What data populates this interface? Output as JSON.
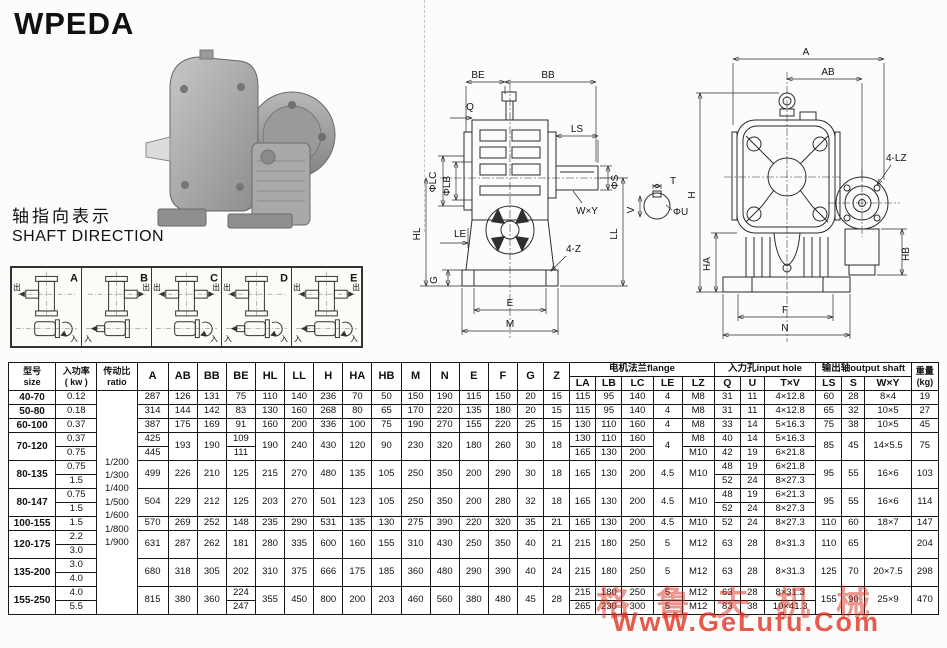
{
  "title": "WPEDA",
  "shaft_direction": {
    "cn": "轴指向表示",
    "en": "SHAFT DIRECTION"
  },
  "shaft_diagrams": {
    "out_label": "出",
    "in_label": "入",
    "items": [
      {
        "label": "A",
        "out_left": true,
        "out_right": false,
        "in_left": false,
        "in_right": true
      },
      {
        "label": "B",
        "out_left": false,
        "out_right": true,
        "in_left": true,
        "in_right": false
      },
      {
        "label": "C",
        "out_left": true,
        "out_right": true,
        "in_left": false,
        "in_right": true
      },
      {
        "label": "D",
        "out_left": true,
        "out_right": false,
        "in_left": true,
        "in_right": true
      },
      {
        "label": "E",
        "out_left": true,
        "out_right": true,
        "in_left": true,
        "in_right": true
      }
    ]
  },
  "drawing_side": {
    "BE": "BE",
    "BB": "BB",
    "Q": "Q",
    "LS": "LS",
    "PHI_S": "ΦS",
    "WxY": "W×Y",
    "PHI_LC": "ΦLC",
    "PHI_LB": "ΦLB",
    "LE": "LE",
    "HL": "HL",
    "LL": "LL",
    "Z4": "4-Z",
    "G": "G",
    "E": "E",
    "M": "M",
    "T": "T",
    "V": "V",
    "PHI_U": "ΦU"
  },
  "drawing_front": {
    "A": "A",
    "AB": "AB",
    "H": "H",
    "HA": "HA",
    "HB": "HB",
    "LZ4": "4-LZ",
    "F": "F",
    "N": "N"
  },
  "table": {
    "header": {
      "size_cn": "型号",
      "size_en": "size",
      "power_cn": "入功率",
      "power_en": "( kw )",
      "ratio_cn": "传动比",
      "ratio_en": "ratio",
      "dims": [
        "A",
        "AB",
        "BB",
        "BE",
        "HL",
        "LL",
        "H",
        "HA",
        "HB",
        "M",
        "N",
        "E",
        "F",
        "G",
        "Z"
      ],
      "flange_group": "电机法兰flange",
      "flange_cols": [
        "LA",
        "LB",
        "LC",
        "LE",
        "LZ"
      ],
      "input_group": "入力孔input hole",
      "input_cols": [
        "Q",
        "U",
        "T×V"
      ],
      "output_group": "输出轴output shaft",
      "output_cols": [
        "LS",
        "S",
        "W×Y"
      ],
      "weight_cn": "重量",
      "weight_en": "(kg)"
    },
    "ratios": [
      "1/200",
      "1/300",
      "1/400",
      "1/500",
      "1/600",
      "1/800",
      "1/900"
    ],
    "rows": [
      [
        {
          "v": "40-70",
          "cls": "model"
        },
        "0.12",
        {
          "ratio": true,
          "r": 16
        },
        "287",
        "126",
        "131",
        "75",
        "110",
        "140",
        "236",
        "70",
        "50",
        "150",
        "190",
        "115",
        "150",
        "20",
        "15",
        "115",
        "95",
        "140",
        "4",
        "M8",
        "31",
        "11",
        "4×12.8",
        "60",
        "28",
        "8×4",
        "19"
      ],
      [
        {
          "v": "50-80",
          "cls": "model"
        },
        "0.18",
        "314",
        "144",
        "142",
        "83",
        "130",
        "160",
        "268",
        "80",
        "65",
        "170",
        "220",
        "135",
        "180",
        "20",
        "15",
        "115",
        "95",
        "140",
        "4",
        "M8",
        "31",
        "11",
        "4×12.8",
        "65",
        "32",
        "10×5",
        "27"
      ],
      [
        {
          "v": "60-100",
          "cls": "model"
        },
        "0.37",
        "387",
        "175",
        "169",
        "91",
        "160",
        "200",
        "336",
        "100",
        "75",
        "190",
        "270",
        "155",
        "220",
        "25",
        "15",
        "130",
        "110",
        "160",
        "4",
        "M8",
        "33",
        "14",
        "5×16.3",
        "75",
        "38",
        "10×5",
        "45"
      ],
      [
        {
          "v": "70-120",
          "cls": "model",
          "r": 2
        },
        "0.37",
        "425",
        {
          "v": "193",
          "r": 2
        },
        {
          "v": "190",
          "r": 2
        },
        "109",
        {
          "v": "190",
          "r": 2
        },
        {
          "v": "240",
          "r": 2
        },
        {
          "v": "430",
          "r": 2
        },
        {
          "v": "120",
          "r": 2
        },
        {
          "v": "90",
          "r": 2
        },
        {
          "v": "230",
          "r": 2
        },
        {
          "v": "320",
          "r": 2
        },
        {
          "v": "180",
          "r": 2
        },
        {
          "v": "260",
          "r": 2
        },
        {
          "v": "30",
          "r": 2
        },
        {
          "v": "18",
          "r": 2
        },
        "130",
        "110",
        "160",
        {
          "v": "4",
          "r": 2
        },
        "M8",
        "40",
        "14",
        "5×16.3",
        {
          "v": "85",
          "r": 2
        },
        {
          "v": "45",
          "r": 2
        },
        {
          "v": "14×5.5",
          "r": 2
        },
        {
          "v": "75",
          "r": 2
        }
      ],
      [
        "0.75",
        "445",
        "111",
        "165",
        "130",
        "200",
        "M10",
        "42",
        "19",
        "6×21.8"
      ],
      [
        {
          "v": "80-135",
          "cls": "model",
          "r": 2
        },
        "0.75",
        {
          "v": "499",
          "r": 2
        },
        {
          "v": "226",
          "r": 2
        },
        {
          "v": "210",
          "r": 2
        },
        {
          "v": "125",
          "r": 2
        },
        {
          "v": "215",
          "r": 2
        },
        {
          "v": "270",
          "r": 2
        },
        {
          "v": "480",
          "r": 2
        },
        {
          "v": "135",
          "r": 2
        },
        {
          "v": "105",
          "r": 2
        },
        {
          "v": "250",
          "r": 2
        },
        {
          "v": "350",
          "r": 2
        },
        {
          "v": "200",
          "r": 2
        },
        {
          "v": "290",
          "r": 2
        },
        {
          "v": "30",
          "r": 2
        },
        {
          "v": "18",
          "r": 2
        },
        {
          "v": "165",
          "r": 2
        },
        {
          "v": "130",
          "r": 2
        },
        {
          "v": "200",
          "r": 2
        },
        {
          "v": "4.5",
          "r": 2
        },
        {
          "v": "M10",
          "r": 2
        },
        "48",
        "19",
        "6×21.8",
        {
          "v": "95",
          "r": 2
        },
        {
          "v": "55",
          "r": 2
        },
        {
          "v": "16×6",
          "r": 2
        },
        {
          "v": "103",
          "r": 2
        }
      ],
      [
        "1.5",
        "52",
        "24",
        "8×27.3"
      ],
      [
        {
          "v": "80-147",
          "cls": "model",
          "r": 2
        },
        "0.75",
        {
          "v": "504",
          "r": 2
        },
        {
          "v": "229",
          "r": 2
        },
        {
          "v": "212",
          "r": 2
        },
        {
          "v": "125",
          "r": 2
        },
        {
          "v": "203",
          "r": 2
        },
        {
          "v": "270",
          "r": 2
        },
        {
          "v": "501",
          "r": 2
        },
        {
          "v": "123",
          "r": 2
        },
        {
          "v": "105",
          "r": 2
        },
        {
          "v": "250",
          "r": 2
        },
        {
          "v": "350",
          "r": 2
        },
        {
          "v": "200",
          "r": 2
        },
        {
          "v": "280",
          "r": 2
        },
        {
          "v": "32",
          "r": 2
        },
        {
          "v": "18",
          "r": 2
        },
        {
          "v": "165",
          "r": 2
        },
        {
          "v": "130",
          "r": 2
        },
        {
          "v": "200",
          "r": 2
        },
        {
          "v": "4.5",
          "r": 2
        },
        {
          "v": "M10",
          "r": 2
        },
        "48",
        "19",
        "6×21.3",
        {
          "v": "95",
          "r": 2
        },
        {
          "v": "55",
          "r": 2
        },
        {
          "v": "16×6",
          "r": 2
        },
        {
          "v": "114",
          "r": 2
        }
      ],
      [
        "1.5",
        "52",
        "24",
        "8×27.3"
      ],
      [
        {
          "v": "100-155",
          "cls": "model"
        },
        "1.5",
        "570",
        "269",
        "252",
        "148",
        "235",
        "290",
        "531",
        "135",
        "130",
        "275",
        "390",
        "220",
        "320",
        "35",
        "21",
        "165",
        "130",
        "200",
        "4.5",
        "M10",
        "52",
        "24",
        "8×27.3",
        "110",
        "60",
        "18×7",
        "147"
      ],
      [
        {
          "v": "120-175",
          "cls": "model",
          "r": 2
        },
        "2.2",
        {
          "v": "631",
          "r": 2
        },
        {
          "v": "287",
          "r": 2
        },
        {
          "v": "262",
          "r": 2
        },
        {
          "v": "181",
          "r": 2
        },
        {
          "v": "280",
          "r": 2
        },
        {
          "v": "335",
          "r": 2
        },
        {
          "v": "600",
          "r": 2
        },
        {
          "v": "160",
          "r": 2
        },
        {
          "v": "155",
          "r": 2
        },
        {
          "v": "310",
          "r": 2
        },
        {
          "v": "430",
          "r": 2
        },
        {
          "v": "250",
          "r": 2
        },
        {
          "v": "350",
          "r": 2
        },
        {
          "v": "40",
          "r": 2
        },
        {
          "v": "21",
          "r": 2
        },
        {
          "v": "215",
          "r": 2
        },
        {
          "v": "180",
          "r": 2
        },
        {
          "v": "250",
          "r": 2
        },
        {
          "v": "5",
          "r": 2
        },
        {
          "v": "M12",
          "r": 2
        },
        {
          "v": "63",
          "r": 2
        },
        {
          "v": "28",
          "r": 2
        },
        {
          "v": "8×31.3",
          "r": 2
        },
        {
          "v": "110",
          "r": 2
        },
        {
          "v": "65",
          "r": 2
        },
        {
          "v": "",
          "r": 2
        },
        {
          "v": "204",
          "r": 2
        }
      ],
      [
        "3.0"
      ],
      [
        {
          "v": "135-200",
          "cls": "model",
          "r": 2
        },
        "3.0",
        {
          "v": "680",
          "r": 2
        },
        {
          "v": "318",
          "r": 2
        },
        {
          "v": "305",
          "r": 2
        },
        {
          "v": "202",
          "r": 2
        },
        {
          "v": "310",
          "r": 2
        },
        {
          "v": "375",
          "r": 2
        },
        {
          "v": "666",
          "r": 2
        },
        {
          "v": "175",
          "r": 2
        },
        {
          "v": "185",
          "r": 2
        },
        {
          "v": "360",
          "r": 2
        },
        {
          "v": "480",
          "r": 2
        },
        {
          "v": "290",
          "r": 2
        },
        {
          "v": "390",
          "r": 2
        },
        {
          "v": "40",
          "r": 2
        },
        {
          "v": "24",
          "r": 2
        },
        {
          "v": "215",
          "r": 2
        },
        {
          "v": "180",
          "r": 2
        },
        {
          "v": "250",
          "r": 2
        },
        {
          "v": "5",
          "r": 2
        },
        {
          "v": "M12",
          "r": 2
        },
        {
          "v": "63",
          "r": 2
        },
        {
          "v": "28",
          "r": 2
        },
        {
          "v": "8×31.3",
          "r": 2
        },
        {
          "v": "125",
          "r": 2
        },
        {
          "v": "70",
          "r": 2
        },
        {
          "v": "20×7.5",
          "r": 2
        },
        {
          "v": "298",
          "r": 2
        }
      ],
      [
        "4.0"
      ],
      [
        {
          "v": "155-250",
          "cls": "model",
          "r": 2
        },
        "4.0",
        {
          "v": "815",
          "r": 2
        },
        {
          "v": "380",
          "r": 2
        },
        {
          "v": "360",
          "r": 2
        },
        "224",
        {
          "v": "355",
          "r": 2
        },
        {
          "v": "450",
          "r": 2
        },
        {
          "v": "800",
          "r": 2
        },
        {
          "v": "200",
          "r": 2
        },
        {
          "v": "203",
          "r": 2
        },
        {
          "v": "460",
          "r": 2
        },
        {
          "v": "560",
          "r": 2
        },
        {
          "v": "380",
          "r": 2
        },
        {
          "v": "480",
          "r": 2
        },
        {
          "v": "45",
          "r": 2
        },
        {
          "v": "28",
          "r": 2
        },
        "215",
        "180",
        "250",
        "5",
        "M12",
        "63",
        "28",
        "8×31.3",
        {
          "v": "155",
          "r": 2
        },
        {
          "v": "90",
          "r": 2
        },
        {
          "v": "25×9",
          "r": 2
        },
        {
          "v": "470",
          "r": 2
        }
      ],
      [
        "5.5",
        "247",
        "265",
        "230",
        "300",
        "5",
        "M12",
        "83",
        "38",
        "10×41.3"
      ]
    ]
  },
  "watermark": {
    "cn": "格鲁夫机械",
    "url": "WwW.GeLufu.Com"
  }
}
